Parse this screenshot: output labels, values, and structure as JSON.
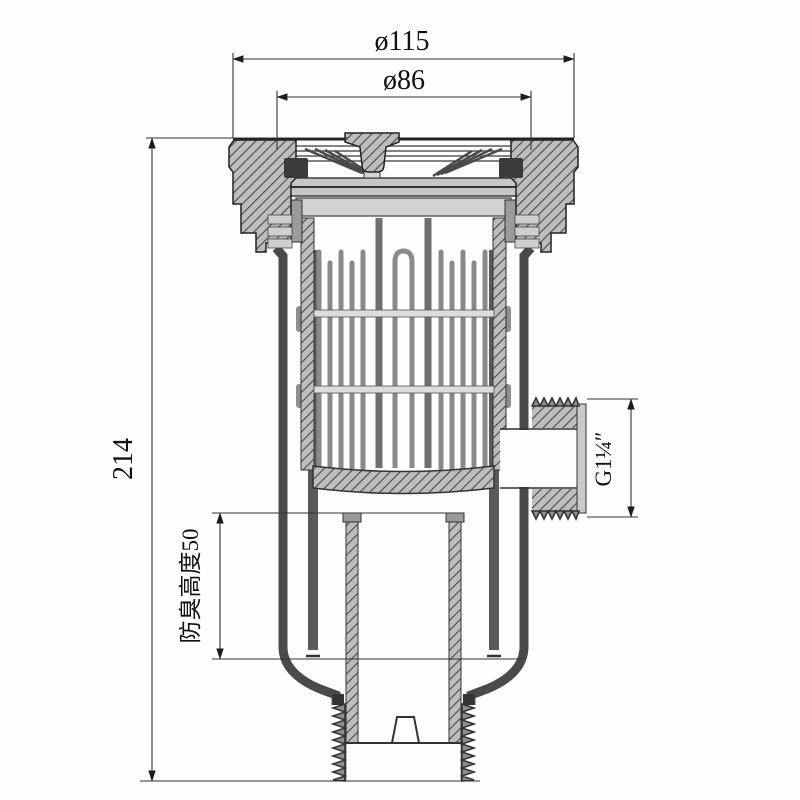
{
  "page": {
    "width": 800,
    "height": 800,
    "background": "#fdfdfd"
  },
  "drawing": {
    "kind": "engineering cross-section, anti-odor floor drain with strainer basket",
    "line_color": "#2f2f2f",
    "hatch_fill": "#bdbdbd",
    "metal_fill": "#c9c9c9",
    "dimensions": {
      "top_outer_diameter": {
        "label": "ø115",
        "value": 115
      },
      "top_inner_diameter": {
        "label": "ø86",
        "value": 86
      },
      "overall_height": {
        "label": "214",
        "value": 214
      },
      "odor_seal_height": {
        "label": "防臭高度50",
        "value": 50
      },
      "side_outlet_thread": {
        "label": "G1¼″"
      }
    }
  }
}
